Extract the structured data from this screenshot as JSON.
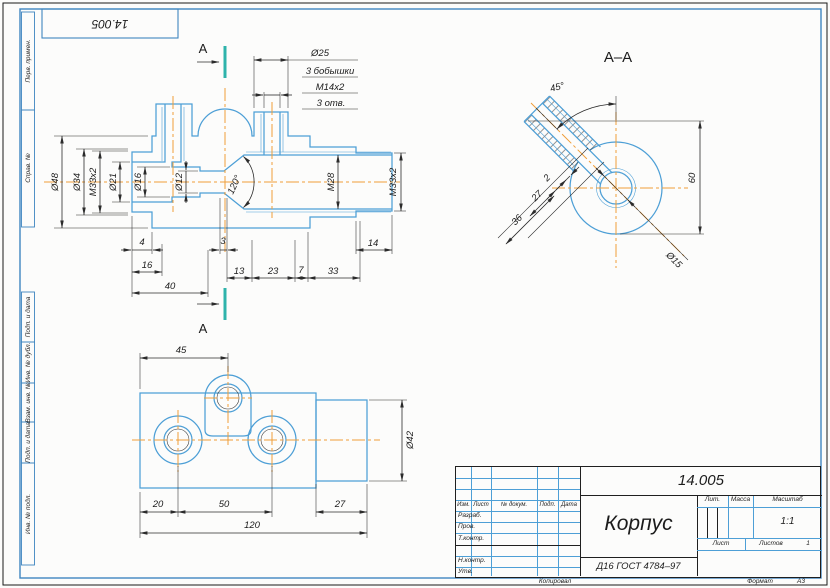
{
  "colors": {
    "outline_blue": "#4d9fd6",
    "centerline_orange": "#ef9e39",
    "section_teal": "#2eb3ab",
    "dim_black": "#2b2b2b",
    "frame_blue": "#3f86c0"
  },
  "stamp": {
    "doc_number": "14.005"
  },
  "margin": {
    "top": [
      "Перв. примен.",
      "Справ. №"
    ],
    "bottom": [
      "Подп. и дата",
      "Инв. № дубл.",
      "Взам. инв. №",
      "Подп. и дата",
      "Инв. № подл."
    ]
  },
  "main_view": {
    "section_letter": "А",
    "callout": [
      "Ø25",
      "3 бобышки",
      "М14х2",
      "3 отв."
    ],
    "left_dims": {
      "d48": "Ø48",
      "d34": "Ø34",
      "m33": "М33х2",
      "d21": "Ø21",
      "d16": "Ø16",
      "d12": "Ø12"
    },
    "angle": "120°",
    "right_dims": {
      "m28": "М28",
      "m33": "М33х2"
    },
    "linear": {
      "n4": "4",
      "n16": "16",
      "n40": "40",
      "n3": "3",
      "n13": "13",
      "n23": "23",
      "n7": "7",
      "n33": "33",
      "n14": "14"
    }
  },
  "section_view": {
    "title": "А–А",
    "angle": "45°",
    "n2": "2",
    "n27": "27",
    "n36": "36",
    "n60": "60",
    "d15": "Ø15"
  },
  "plan_view": {
    "n45": "45",
    "d42": "Ø42",
    "n20": "20",
    "n50": "50",
    "n27": "27",
    "n120": "120"
  },
  "title_block": {
    "doc_number": "14.005",
    "part_name": "Корпус",
    "material": "Д16 ГОСТ 4784–97",
    "cols": [
      "Изм.",
      "Лист",
      "№ докум.",
      "Подп.",
      "Дата"
    ],
    "rows": [
      "Разраб.",
      "Пров.",
      "Т.контр.",
      "Н.контр.",
      "Утв."
    ],
    "lit": "Лит.",
    "mass": "Масса",
    "scale_label": "Масштаб",
    "scale": "1:1",
    "sheet": "Лист",
    "sheets": "Листов",
    "sheets_value": "1",
    "copied": "Копировал",
    "format_label": "Формат",
    "format": "А3"
  }
}
